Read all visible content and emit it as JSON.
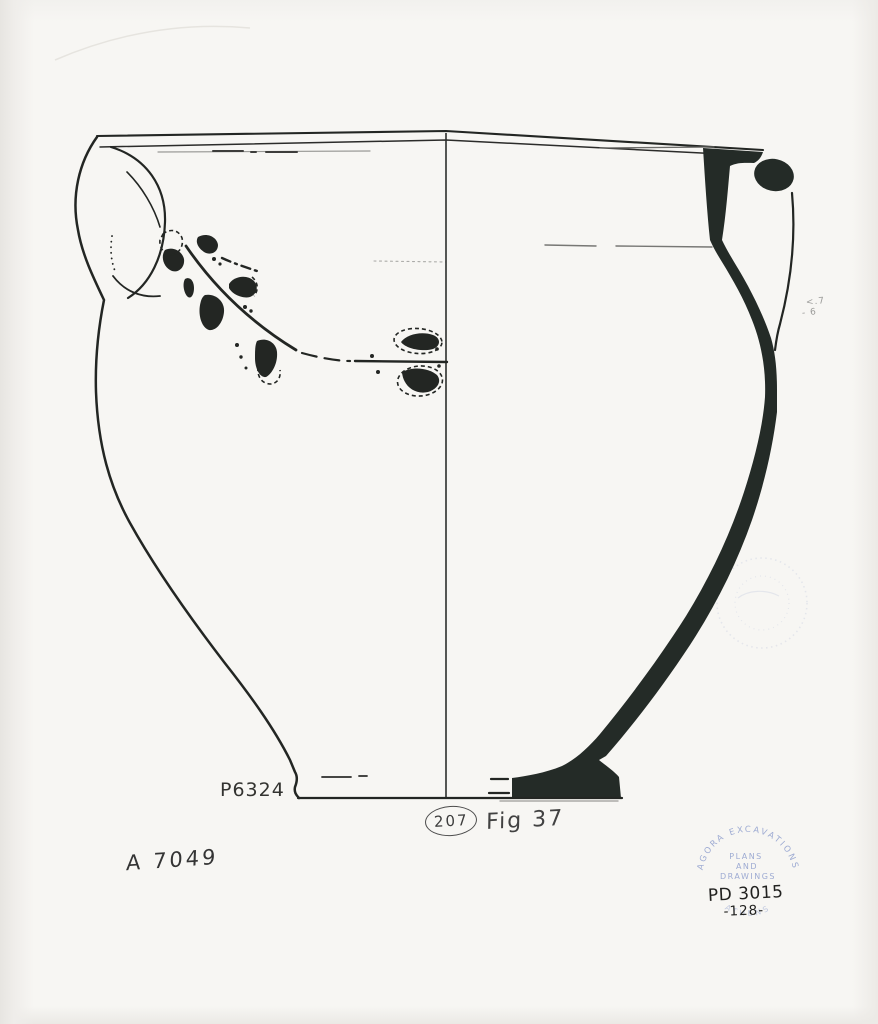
{
  "labels": {
    "catalog_number": "P6324",
    "negative_number": "A 7049",
    "figure": "Fig 37",
    "plate_circled": "207"
  },
  "pencil_marks": {
    "upper": "<.7",
    "lower": "- 6"
  },
  "stamp": {
    "arc_top": "AGORA EXCAVATIONS",
    "arc_bottom": "ATHENS",
    "center_line1": "PLANS",
    "center_line2": "AND",
    "center_line3": "DRAWINGS",
    "inventory_number": "PD 3015",
    "item_number": "-128-"
  },
  "colors": {
    "paper": "#f7f6f3",
    "ink": "#232623",
    "section_fill": "#242b27",
    "pencil_gray": "#555555",
    "stamp_blue": "#7b8ec6"
  }
}
